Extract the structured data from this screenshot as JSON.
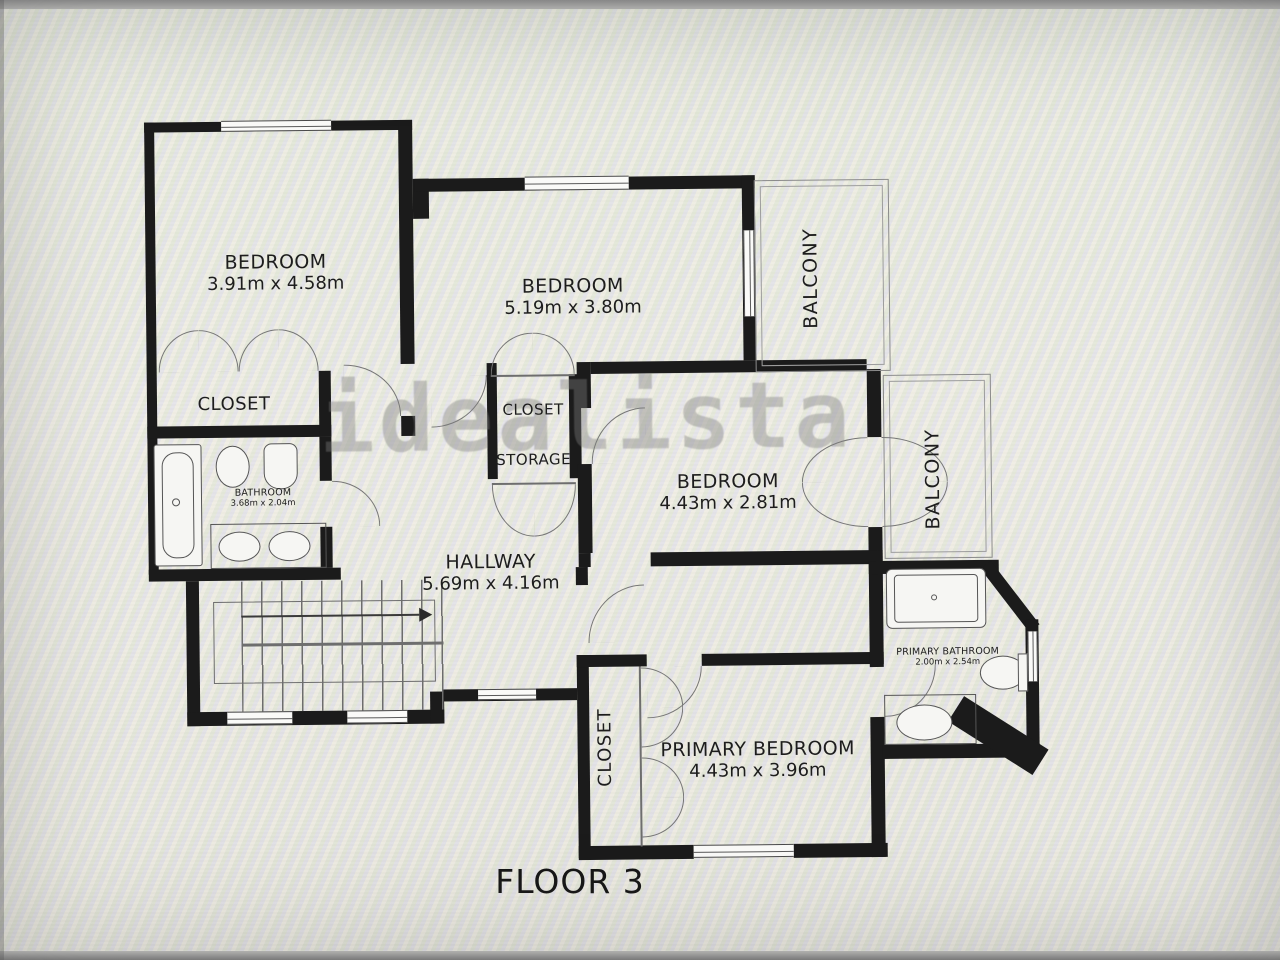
{
  "floor_plan": {
    "floor_label": "FLOOR 3",
    "watermark": "idealista",
    "rooms": {
      "bedroom1": {
        "name": "BEDROOM",
        "dims": "3.91m x 4.58m"
      },
      "bedroom2": {
        "name": "BEDROOM",
        "dims": "5.19m x 3.80m"
      },
      "bedroom3": {
        "name": "BEDROOM",
        "dims": "4.43m x 2.81m"
      },
      "primary_bedroom": {
        "name": "PRIMARY BEDROOM",
        "dims": "4.43m x 3.96m"
      },
      "hallway": {
        "name": "HALLWAY",
        "dims": "5.69m x 4.16m"
      },
      "bathroom": {
        "name": "BATHROOM",
        "dims": "3.68m x 2.04m"
      },
      "primary_bathroom": {
        "name": "PRIMARY BATHROOM",
        "dims": "2.00m x 2.54m"
      },
      "closet_bedroom1": {
        "name": "CLOSET"
      },
      "closet_hall": {
        "name": "CLOSET"
      },
      "storage": {
        "name": "STORAGE"
      },
      "closet_primary": {
        "name": "CLOSET"
      },
      "balcony_top": {
        "name": "BALCONY"
      },
      "balcony_right": {
        "name": "BALCONY"
      }
    }
  }
}
